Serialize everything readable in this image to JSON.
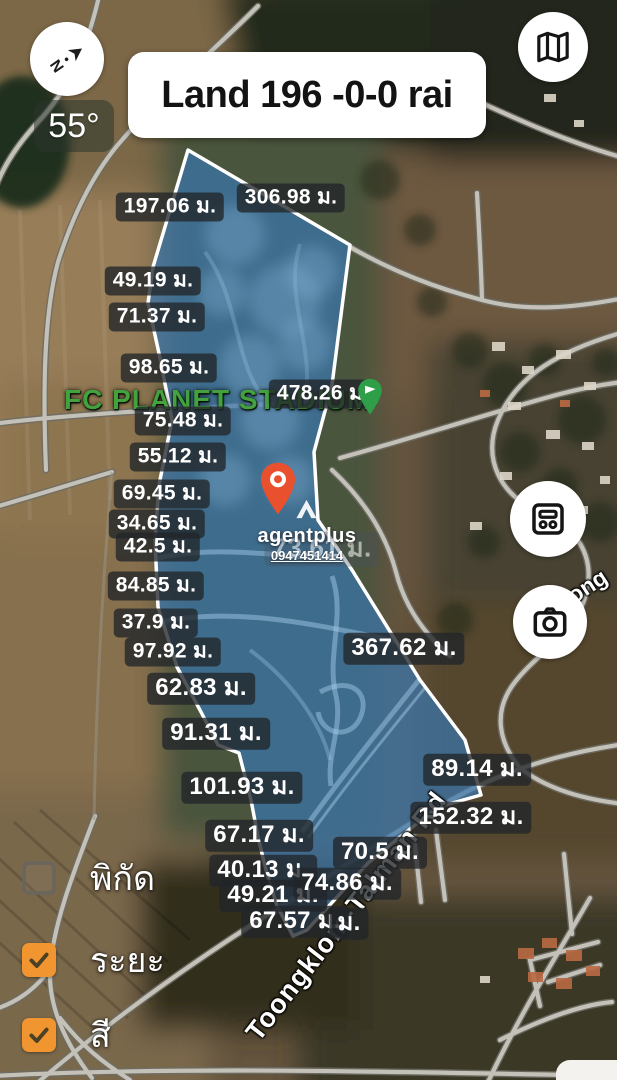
{
  "header": {
    "title": "Land 196 -0-0 rai",
    "compass_heading": "55°"
  },
  "map": {
    "stadium_label": "FC PLANET STADIUM",
    "road_label_main": "Toongklom-Talman Rd",
    "road_label_fragment": "oong",
    "unit_suffix": "ม.",
    "measurements": [
      {
        "text": "197.06 ม.",
        "x": 170,
        "y": 207
      },
      {
        "text": "306.98 ม.",
        "x": 291,
        "y": 198
      },
      {
        "text": "49.19 ม.",
        "x": 153,
        "y": 281
      },
      {
        "text": "71.37 ม.",
        "x": 157,
        "y": 317
      },
      {
        "text": "98.65 ม.",
        "x": 169,
        "y": 368
      },
      {
        "text": "478.26 ม.",
        "x": 323,
        "y": 394
      },
      {
        "text": "75.48 ม.",
        "x": 183,
        "y": 421
      },
      {
        "text": "55.12 ม.",
        "x": 178,
        "y": 457
      },
      {
        "text": "69.45 ม.",
        "x": 162,
        "y": 494
      },
      {
        "text": "34.65 ม.",
        "x": 157,
        "y": 524
      },
      {
        "text": "42.5 ม.",
        "x": 158,
        "y": 547
      },
      {
        "text": "84.85 ม.",
        "x": 156,
        "y": 586
      },
      {
        "text": "37.9 ม.",
        "x": 156,
        "y": 623
      },
      {
        "text": "97.92 ม.",
        "x": 173,
        "y": 652
      },
      {
        "text": "62.83 ม.",
        "x": 201,
        "y": 689,
        "lg": true
      },
      {
        "text": "91.31 ม.",
        "x": 216,
        "y": 734,
        "lg": true
      },
      {
        "text": "101.93 ม.",
        "x": 242,
        "y": 788,
        "lg": true
      },
      {
        "text": "67.17 ม.",
        "x": 259,
        "y": 836,
        "lg": true
      },
      {
        "text": "40.13 ม.",
        "x": 263,
        "y": 871,
        "lg": true
      },
      {
        "text": "49.21 ม.",
        "x": 273,
        "y": 896,
        "lg": true
      },
      {
        "text": "67.57 ม.",
        "x": 295,
        "y": 922,
        "lg": true
      },
      {
        "text": "ม.",
        "x": 349,
        "y": 924,
        "lg": true
      },
      {
        "text": "74.86 ม.",
        "x": 347,
        "y": 884,
        "lg": true
      },
      {
        "text": "70.5 ม.",
        "x": 380,
        "y": 853,
        "lg": true
      },
      {
        "text": "152.32 ม.",
        "x": 471,
        "y": 818,
        "lg": true
      },
      {
        "text": "89.14 ม.",
        "x": 477,
        "y": 770,
        "lg": true
      },
      {
        "text": "367.62 ม.",
        "x": 404,
        "y": 649,
        "lg": true
      },
      {
        "text": "73.61 ม.",
        "x": 322,
        "y": 549,
        "lg": true,
        "dim": true
      }
    ]
  },
  "watermark": {
    "brand": "agentplus",
    "phone": "0947451414"
  },
  "panel": {
    "checkboxes": [
      {
        "label": "พิกัด",
        "checked": false
      },
      {
        "label": "ระยะ",
        "checked": true
      },
      {
        "label": "สี",
        "checked": true
      }
    ]
  },
  "colors": {
    "checkbox_orange": "#F0952F",
    "polygon_fill": "#3A76AC",
    "polygon_border": "#FFFFFF",
    "stadium_green": "#43A23E",
    "marker_red": "#E8502E",
    "marker_green": "#2F9E48",
    "label_bg": "rgba(33,37,41,0.78)"
  }
}
